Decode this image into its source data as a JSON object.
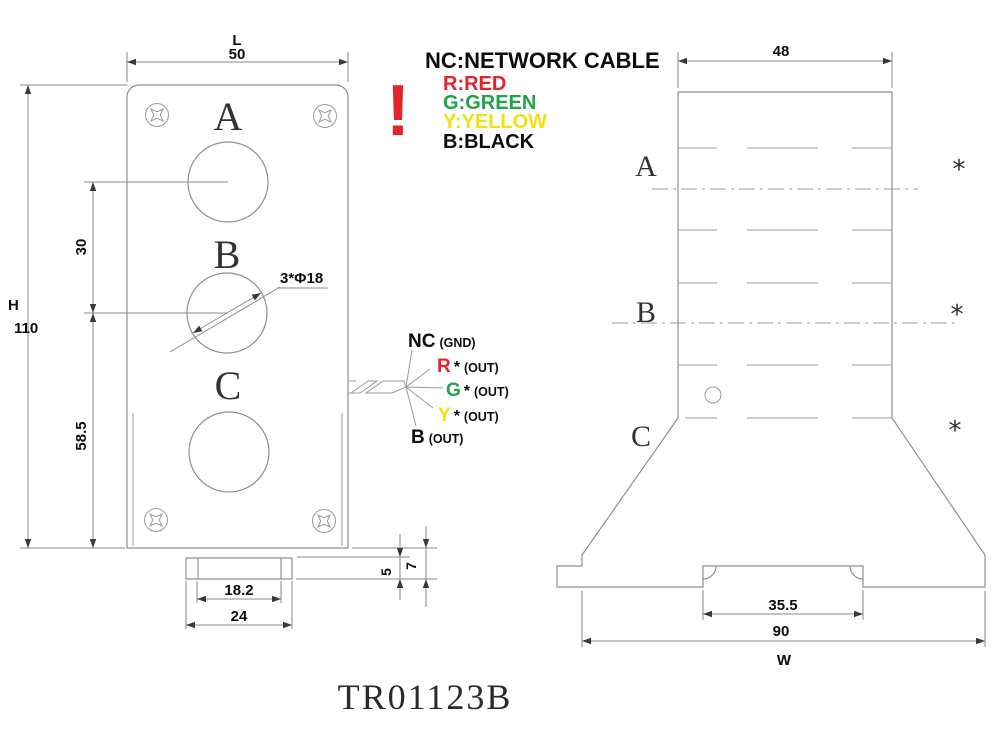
{
  "page": {
    "title_code": "TR01123B"
  },
  "colors": {
    "red": "#e2252b",
    "green": "#21a348",
    "yellow": "#f2e10e",
    "black": "#0d0d0d",
    "drawing_line": "#8f8f8f"
  },
  "legend": {
    "warning_mark": "!",
    "items": [
      {
        "text": "NC:NETWORK CABLE",
        "color": "#0d0d0d"
      },
      {
        "text": "R:RED",
        "color": "#e2252b"
      },
      {
        "text": "G:GREEN",
        "color": "#21a348"
      },
      {
        "text": "Y:YELLOW",
        "color": "#f2e10e"
      },
      {
        "text": "B:BLACK",
        "color": "#0d0d0d"
      }
    ]
  },
  "front_view": {
    "stack_labels": [
      "A",
      "B",
      "C"
    ],
    "hole_note": "3*Φ18",
    "dimensions": {
      "width_letter": "L",
      "width_value": "50",
      "height_letter": "H",
      "height_value": "110",
      "hole_pitch": "30",
      "lower_span": "58.5",
      "foot_inner": "18.2",
      "foot_outer": "24",
      "foot_step": "5",
      "foot_height": "7"
    }
  },
  "side_view": {
    "stack_labels": [
      "A",
      "B",
      "C"
    ],
    "marks": [
      "*",
      "*",
      "*"
    ],
    "dimensions": {
      "head_width": "48",
      "slot_width": "35.5",
      "base_width": "90",
      "base_letter": "W"
    }
  },
  "wiring": {
    "leads": [
      {
        "label": "NC",
        "star": "",
        "note": "(GND)",
        "color": "#0d0d0d"
      },
      {
        "label": "R",
        "star": "*",
        "note": "(OUT)",
        "color": "#e2252b"
      },
      {
        "label": "G",
        "star": "*",
        "note": "(OUT)",
        "color": "#21a348"
      },
      {
        "label": "Y",
        "star": "*",
        "note": "(OUT)",
        "color": "#f2e10e"
      },
      {
        "label": "B",
        "star": "",
        "note": "(OUT)",
        "color": "#0d0d0d"
      }
    ]
  }
}
